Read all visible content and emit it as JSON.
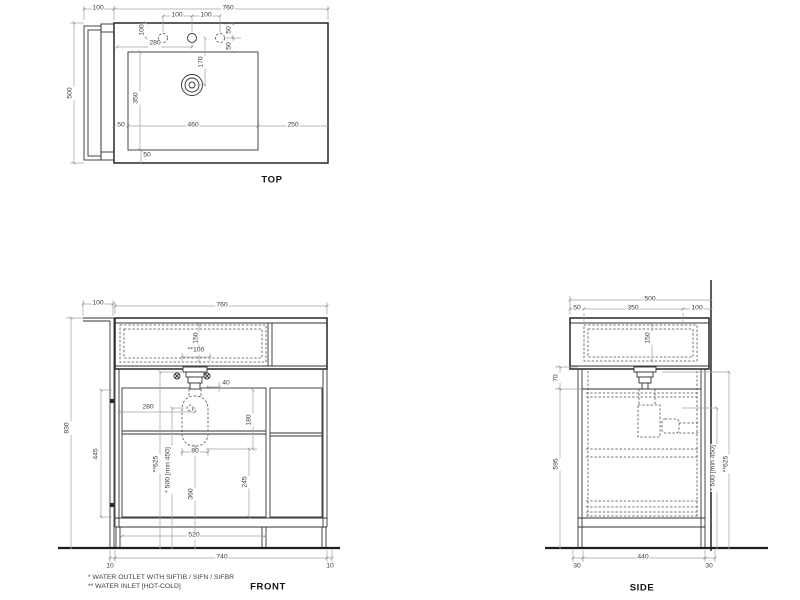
{
  "top": {
    "label": "TOP",
    "overhang": "100",
    "width": "760",
    "depth": "500",
    "hole_gap_left": "100",
    "hole_gap_right": "100",
    "hole_offset": "100",
    "tap_from_left": "280",
    "right_hole_off_a": "50",
    "right_hole_off_b": "50",
    "drain_from_holes": "170",
    "basin_width": "460",
    "basin_depth": "350",
    "margin_left": "50",
    "margin_right": "250",
    "margin_bottom": "50"
  },
  "front": {
    "label": "FRONT",
    "overhang": "100",
    "width": "760",
    "height": "830",
    "basin_height": "150",
    "inlet_gap": "**100",
    "offset": "40",
    "drain_from_left": "280",
    "drop": "180",
    "trap_width": "80",
    "trap_to_bottom": "245",
    "trap_height": "360",
    "water_outlet_height": "* 500 [min 450]",
    "water_inlet_height": "**625",
    "door_height": "445",
    "plinth_span": "520",
    "base_width": "740",
    "foot_left": "10",
    "foot_right": "10"
  },
  "side": {
    "label": "SIDE",
    "depth": "500",
    "front_offset": "50",
    "basin_span": "350",
    "back_offset": "100",
    "basin_height": "150",
    "apron": "70",
    "cabinet_height": "595",
    "water_outlet_height": "* 500 [min 450]",
    "water_inlet_height": "**625",
    "base_depth": "440",
    "foot_front": "30",
    "foot_back": "30"
  },
  "notes": {
    "line1": "* WATER OUTLET WITH SIFTIB / SIFN / SIFBR",
    "line2": "** WATER INLET [HOT-COLD]"
  },
  "colors": {
    "object_line": "#262626",
    "dim_line": "#a3a3a3",
    "dim_text": "#3f3f3f",
    "background": "#ffffff"
  }
}
